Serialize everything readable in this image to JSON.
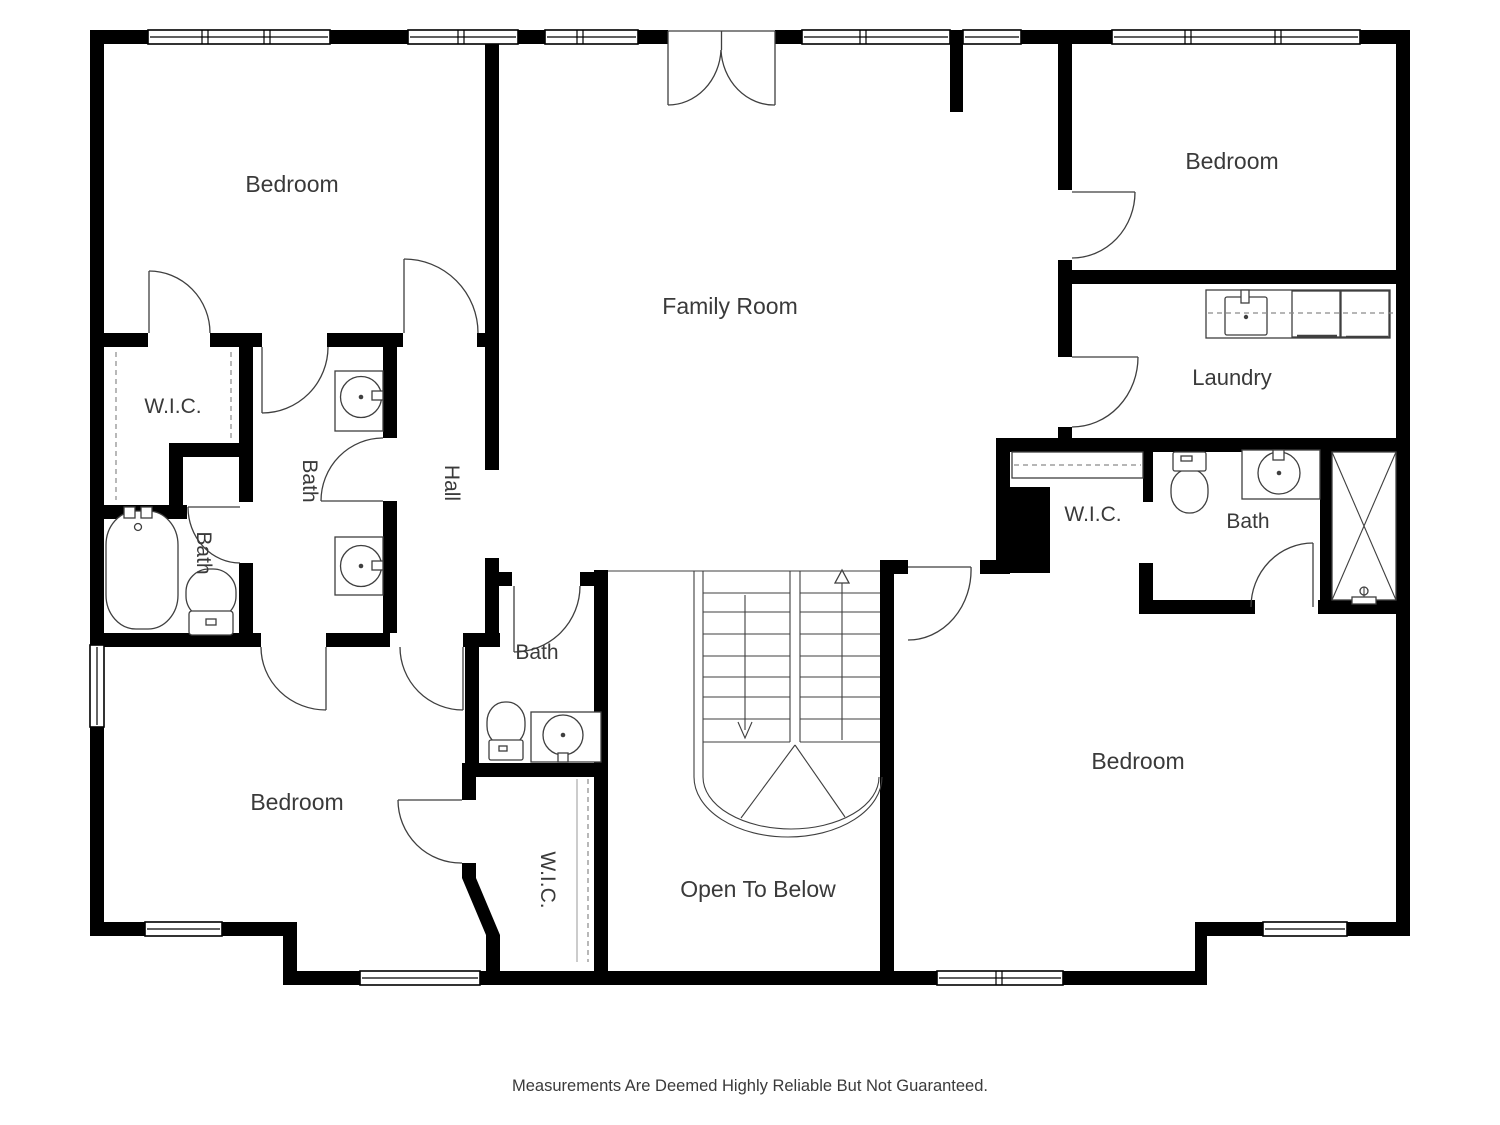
{
  "rooms": {
    "bedroom_top_left": {
      "label": "Bedroom"
    },
    "family_room": {
      "label": "Family Room"
    },
    "bedroom_top_right": {
      "label": "Bedroom"
    },
    "laundry": {
      "label": "Laundry"
    },
    "wic_top_left": {
      "label": "W.I.C."
    },
    "bath_left": {
      "label": "Bath"
    },
    "bath_middle": {
      "label": "Bath"
    },
    "hall": {
      "label": "Hall"
    },
    "bath_center": {
      "label": "Bath"
    },
    "wic_center": {
      "label": "W.I.C."
    },
    "bedroom_bottom_left": {
      "label": "Bedroom"
    },
    "open_to_below": {
      "label": "Open To Below"
    },
    "bedroom_bottom_right": {
      "label": "Bedroom"
    },
    "wic_right": {
      "label": "W.I.C."
    },
    "bath_right": {
      "label": "Bath"
    }
  },
  "footer": {
    "disclaimer": "Measurements Are Deemed Highly Reliable But Not Guaranteed."
  },
  "fixtures": [
    "bathtub",
    "toilet",
    "round-sink",
    "double-vanity",
    "shower",
    "laundry-counter",
    "washer",
    "dryer",
    "laundry-sink",
    "closet-rod",
    "stairs-up-arrow",
    "stairs-down-arrow",
    "french-doors"
  ],
  "colors": {
    "wall": "#000000",
    "line": "#3f3f3f",
    "text": "#3a3a3a",
    "dash": "#8a8a8a",
    "bg": "#ffffff"
  }
}
